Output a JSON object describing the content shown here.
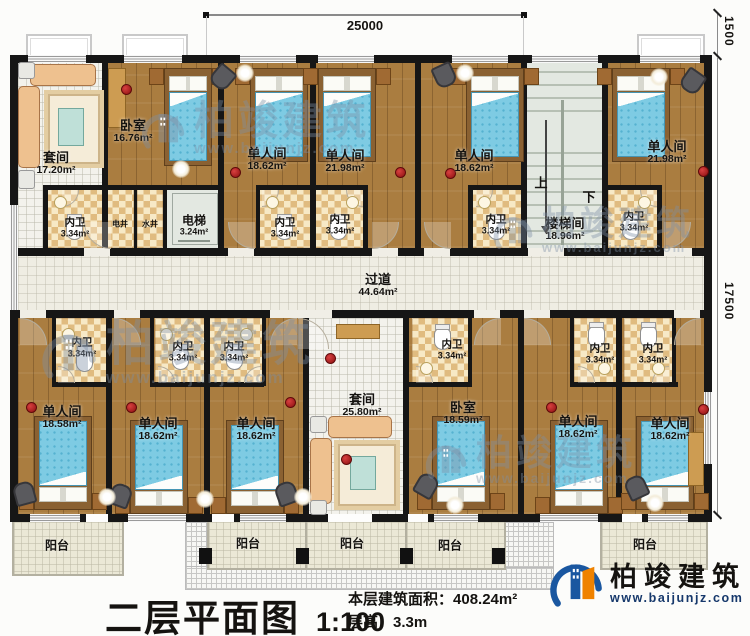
{
  "plan": {
    "rooms": [
      {
        "label": "套间",
        "area": "17.20m²"
      },
      {
        "label": "卧室",
        "area": "16.76m²"
      },
      {
        "label": "单人间",
        "area": "18.62m²"
      },
      {
        "label": "单人间",
        "area": "21.98m²"
      },
      {
        "label": "单人间",
        "area": "18.62m²"
      },
      {
        "label": "楼梯间",
        "area": "18.96m²"
      },
      {
        "label": "单人间",
        "area": "21.98m²"
      },
      {
        "label": "单人间",
        "area": "18.58m²"
      },
      {
        "label": "单人间",
        "area": "18.62m²"
      },
      {
        "label": "单人间",
        "area": "18.62m²"
      },
      {
        "label": "套间",
        "area": "25.80m²"
      },
      {
        "label": "卧室",
        "area": "18.59m²"
      },
      {
        "label": "单人间",
        "area": "18.62m²"
      },
      {
        "label": "单人间",
        "area": "18.62m²"
      }
    ],
    "bath": {
      "label": "内卫",
      "area": "3.34m²"
    },
    "elevator": {
      "label": "电梯",
      "area": "3.24m²"
    },
    "shaft_electric": "电井",
    "shaft_water": "水井",
    "corridor": {
      "label": "过道",
      "area": "44.64m²"
    },
    "stairs": {
      "up": "上",
      "down": "下"
    },
    "balcony": "阳台",
    "dims": {
      "width": "25000",
      "side_offset": "1500",
      "depth": "17500"
    }
  },
  "title_block": {
    "title": "二层平面图",
    "scale": "1:100",
    "area_label": "本层建筑面积：",
    "area_value": "408.24m²",
    "height_label": "层高：",
    "height_value": "3.3m"
  },
  "brand": {
    "name": "柏竣建筑",
    "site": "www.baijunjz.com"
  }
}
